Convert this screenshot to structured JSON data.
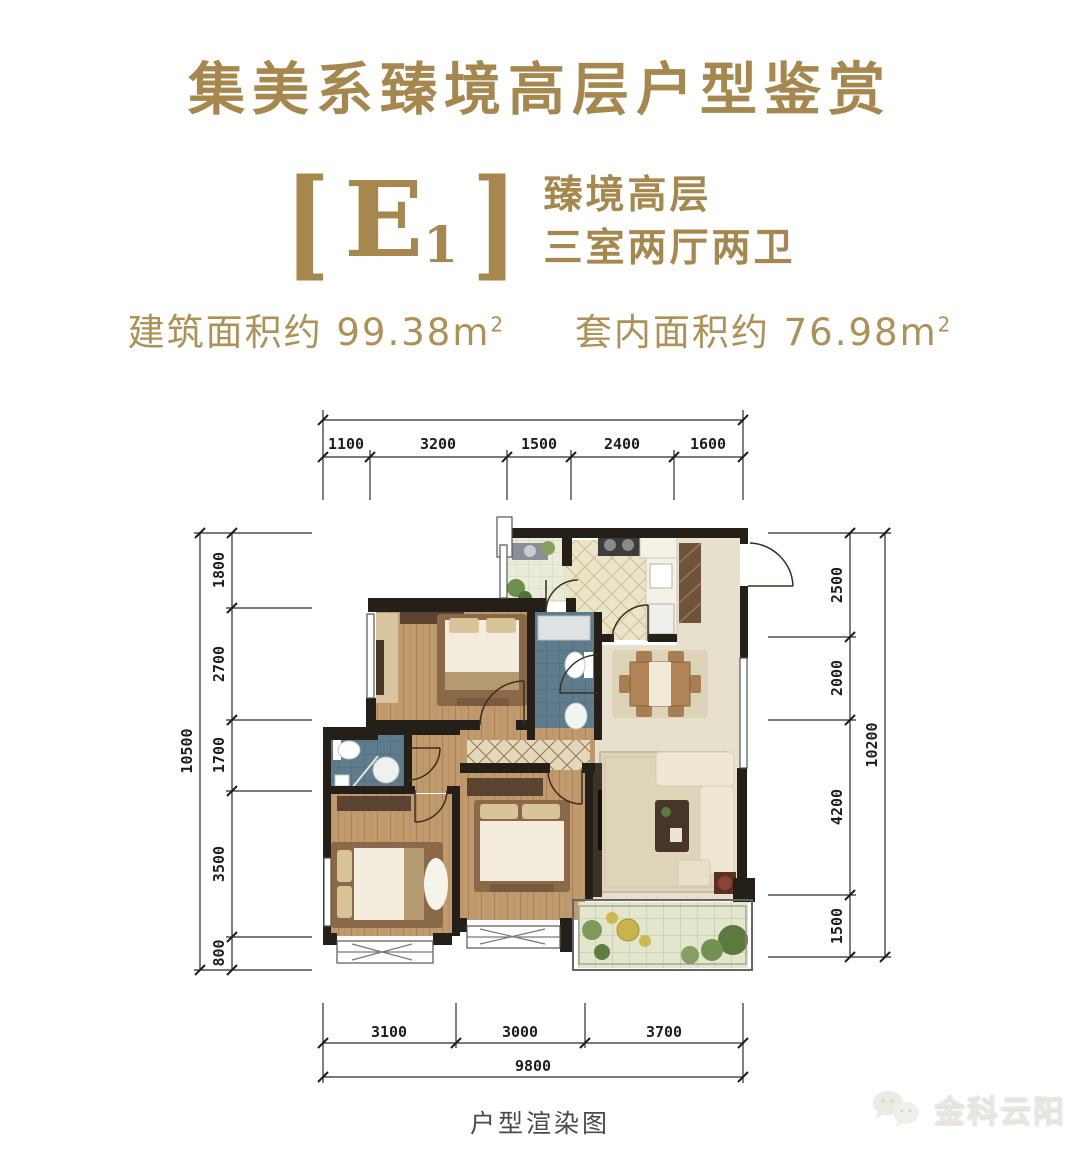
{
  "header": {
    "title": "集美系臻境高层户型鉴赏",
    "unit": {
      "bracket_left": "[",
      "letter": "E",
      "subscript": "1",
      "bracket_right": "]",
      "line1": "臻境高层",
      "line2": "三室两厅两卫"
    },
    "areas": {
      "built": {
        "label": "建筑面积约",
        "value": "99.38",
        "unit": "m",
        "sup": "2"
      },
      "inner": {
        "label": "套内面积约",
        "value": "76.98",
        "unit": "m",
        "sup": "2"
      }
    }
  },
  "plan": {
    "dims": {
      "top": {
        "segments": [
          "1100",
          "3200",
          "1500",
          "2400",
          "1600"
        ]
      },
      "left": {
        "total": "10500",
        "segments": [
          "1800",
          "2700",
          "1700",
          "3500",
          "800"
        ]
      },
      "right": {
        "total": "10200",
        "segments": [
          "2500",
          "2000",
          "4200",
          "1500"
        ]
      },
      "bottom": {
        "total": "9800",
        "segments": [
          "3100",
          "3000",
          "3700"
        ]
      }
    }
  },
  "footer": {
    "caption": "户型渲染图",
    "watermark": {
      "text": "金科云阳",
      "icon": "wechat-bubbles-icon"
    }
  },
  "colors": {
    "gold": "#a6874e",
    "gold_light": "#ae9157",
    "dimension_line": "#2b2b2b",
    "wall": "#241f19",
    "wood_floor": "#bf9a6a",
    "bath_tile": "#5e7c8b",
    "kitchen_tile": "#ece4c8",
    "hall_beige": "#e7e0cc",
    "balcony_green": "#6f8f4e"
  }
}
